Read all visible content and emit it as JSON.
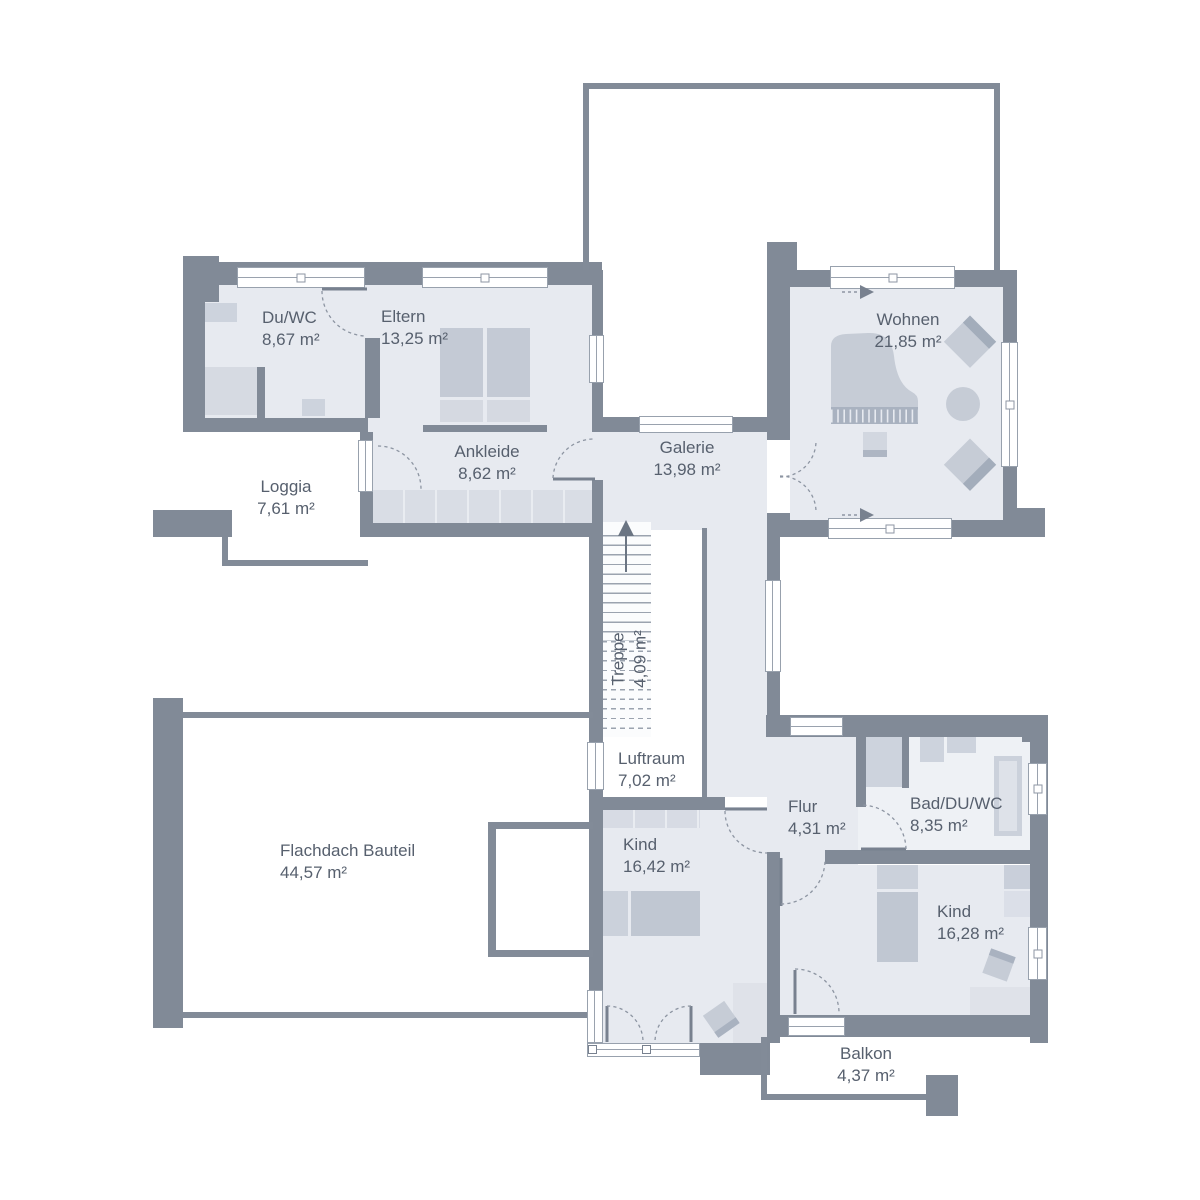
{
  "plan": {
    "type": "floor-plan",
    "language": "de",
    "colors": {
      "wall": "#818a97",
      "room_fill": "#e7eaf0",
      "bath_fill": "#eef1f5",
      "furniture": "#c6ccd6",
      "furniture_dark": "#a9b2c0",
      "label_text": "#57606e",
      "window_frame": "#98a1ad",
      "stairs_fill": "#fbfcfd"
    },
    "rooms": [
      {
        "id": "duwc",
        "name": "Du/WC",
        "area": "8,67 m²"
      },
      {
        "id": "eltern",
        "name": "Eltern",
        "area": "13,25 m²"
      },
      {
        "id": "ankleide",
        "name": "Ankleide",
        "area": "8,62 m²"
      },
      {
        "id": "loggia",
        "name": "Loggia",
        "area": "7,61 m²"
      },
      {
        "id": "galerie",
        "name": "Galerie",
        "area": "13,98 m²"
      },
      {
        "id": "wohnen",
        "name": "Wohnen",
        "area": "21,85 m²"
      },
      {
        "id": "treppe",
        "name": "Treppe",
        "area": "4,09 m²"
      },
      {
        "id": "luftraum",
        "name": "Luftraum",
        "area": "7,02 m²"
      },
      {
        "id": "flur",
        "name": "Flur",
        "area": "4,31 m²"
      },
      {
        "id": "bad",
        "name": "Bad/DU/WC",
        "area": "8,35 m²"
      },
      {
        "id": "kind-1",
        "name": "Kind",
        "area": "16,42 m²"
      },
      {
        "id": "kind-2",
        "name": "Kind",
        "area": "16,28 m²"
      },
      {
        "id": "flachdach",
        "name": "Flachdach Bauteil",
        "area": "44,57 m²"
      },
      {
        "id": "balkon",
        "name": "Balkon",
        "area": "4,37 m²"
      }
    ],
    "stairs": {
      "label": "Treppe",
      "area": "4,09 m²",
      "direction": "up"
    }
  }
}
